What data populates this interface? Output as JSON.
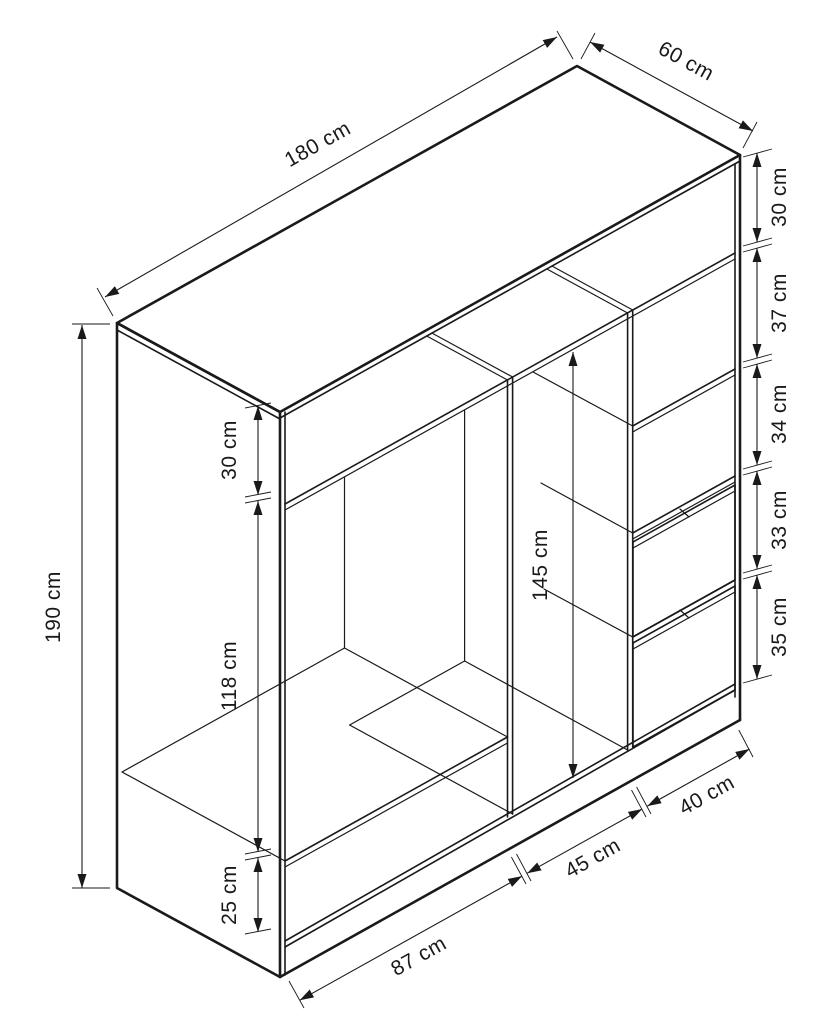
{
  "figure": {
    "kind": "furniture-dimension-diagram",
    "object": "wardrobe",
    "units": "cm",
    "colors": {
      "line": "#1a1a1a",
      "background": "#ffffff"
    },
    "overall": {
      "width": "180 cm",
      "depth": "60 cm",
      "height": "190 cm"
    },
    "left_section": {
      "top_gap": "30 cm",
      "hanging_space": "118 cm",
      "bottom_gap": "25 cm"
    },
    "middle_section": {
      "hanging_space": "145 cm"
    },
    "right_section": {
      "gaps": [
        "30 cm",
        "37 cm",
        "34 cm",
        "33 cm",
        "35 cm"
      ]
    },
    "bottom_widths": {
      "left": "87 cm",
      "middle": "45 cm",
      "right": "40 cm"
    }
  }
}
